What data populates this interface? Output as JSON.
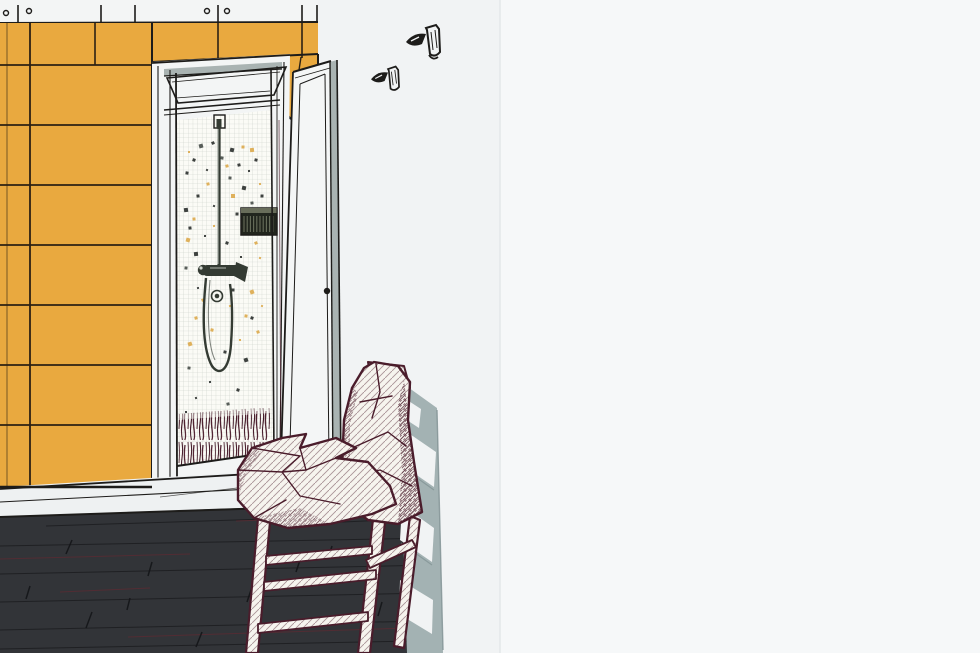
{
  "scene": {
    "description": "bathroom-corner-illustration",
    "canvas": {
      "width": 980,
      "height": 653,
      "illustration_width": 500
    },
    "colors": {
      "paper": "#f1f3f4",
      "paper_right": "#f6f8f9",
      "ink": "#1d1c1a",
      "grout": "#2c2113",
      "tile_yellow": "#e9a93f",
      "niche_white": "#f3f5f5",
      "door_white": "#f4f6f6",
      "door_edge_gray": "#a9b3b2",
      "mosaic_bg": "#fbfbf6",
      "mosaic_grid": "#c8cdc7",
      "speck_dark": "#2e3230",
      "speck_soft": "#4a504c",
      "speck_tan": "#dcaa4e",
      "metal_dark": "#343b33",
      "metal_light": "#cfd4cc",
      "radio_body": "#21251d",
      "radio_slat": "#707662",
      "maroon": "#4a1c2b",
      "maroon_deep": "#401624",
      "fabric_cream": "#f6f4ee",
      "shadow_gray": "#a3b2b3",
      "shadow_gray_dark": "#7f9092",
      "floor_dark": "#323438",
      "floor_seam": "#1d1e21",
      "floor_seam_red": "#5a2b33",
      "baseboard_white": "#eef1f2",
      "divider": "#e4e8e9"
    },
    "top_strip": {
      "end_x": 318,
      "height": 23,
      "ticks": [
        18,
        101,
        135,
        218,
        302,
        317
      ],
      "screws": [
        [
          6,
          13
        ],
        [
          29,
          11
        ],
        [
          207,
          11
        ],
        [
          227,
          11
        ]
      ]
    },
    "tile_wall": {
      "x": 0,
      "y": 23,
      "width": 152,
      "bottom": 487,
      "row_lines": [
        65,
        125,
        185,
        245,
        305,
        365,
        425
      ],
      "column_joint_x": 30,
      "row1_joint_x": 95,
      "left_inner_line_x": 7,
      "top_band": {
        "x1": 152,
        "x2": 318,
        "top": 23,
        "bl": 62,
        "br": 54,
        "joints": [
          218,
          302
        ]
      }
    },
    "mosaic_speckles": [
      [
        201,
        146,
        4,
        0
      ],
      [
        213,
        143,
        3,
        0
      ],
      [
        194,
        160,
        3,
        0
      ],
      [
        187,
        173,
        3,
        0
      ],
      [
        207,
        170,
        2,
        0
      ],
      [
        222,
        158,
        3,
        0
      ],
      [
        232,
        150,
        4,
        0
      ],
      [
        239,
        165,
        3,
        0
      ],
      [
        249,
        171,
        2,
        0
      ],
      [
        256,
        160,
        3,
        0
      ],
      [
        230,
        178,
        3,
        0
      ],
      [
        244,
        188,
        4,
        0
      ],
      [
        198,
        196,
        3,
        0
      ],
      [
        186,
        210,
        4,
        0
      ],
      [
        214,
        206,
        2,
        0
      ],
      [
        252,
        203,
        3,
        0
      ],
      [
        262,
        196,
        3,
        0
      ],
      [
        237,
        214,
        3,
        0
      ],
      [
        190,
        228,
        3,
        0
      ],
      [
        205,
        236,
        2,
        0
      ],
      [
        246,
        232,
        3,
        0
      ],
      [
        258,
        226,
        2,
        0
      ],
      [
        227,
        243,
        3,
        0
      ],
      [
        196,
        254,
        4,
        0
      ],
      [
        241,
        257,
        2,
        0
      ],
      [
        186,
        268,
        3,
        0
      ],
      [
        233,
        290,
        3,
        0
      ],
      [
        198,
        288,
        2,
        0
      ],
      [
        252,
        318,
        3,
        0
      ],
      [
        225,
        352,
        3,
        0
      ],
      [
        189,
        368,
        3,
        0
      ],
      [
        246,
        360,
        4,
        0
      ],
      [
        210,
        382,
        2,
        0
      ],
      [
        238,
        390,
        3,
        0
      ],
      [
        196,
        398,
        2,
        0
      ],
      [
        228,
        404,
        3,
        0
      ],
      [
        186,
        412,
        2,
        0
      ],
      [
        219,
        139,
        3,
        1
      ],
      [
        243,
        147,
        3,
        1
      ],
      [
        189,
        152,
        2,
        1
      ],
      [
        227,
        166,
        3,
        1
      ],
      [
        252,
        150,
        4,
        1
      ],
      [
        208,
        184,
        3,
        1
      ],
      [
        233,
        196,
        4,
        1
      ],
      [
        260,
        184,
        2,
        1
      ],
      [
        194,
        219,
        3,
        1
      ],
      [
        249,
        216,
        4,
        1
      ],
      [
        214,
        226,
        2,
        1
      ],
      [
        256,
        243,
        3,
        1
      ],
      [
        188,
        240,
        4,
        1
      ],
      [
        235,
        268,
        3,
        1
      ],
      [
        260,
        258,
        2,
        1
      ],
      [
        203,
        300,
        3,
        1
      ],
      [
        252,
        292,
        4,
        1
      ],
      [
        230,
        306,
        2,
        1
      ],
      [
        196,
        318,
        3,
        1
      ],
      [
        246,
        316,
        3,
        1
      ],
      [
        262,
        306,
        2,
        1
      ],
      [
        212,
        330,
        3,
        1
      ],
      [
        190,
        344,
        4,
        1
      ],
      [
        240,
        340,
        2,
        1
      ],
      [
        258,
        332,
        3,
        1
      ]
    ],
    "hooks": [
      {
        "x": 406,
        "y": 24,
        "scale": 1.0
      },
      {
        "x": 371,
        "y": 64,
        "scale": 0.85
      }
    ],
    "floor": {
      "dark_seams": [
        [
          0,
          546,
          436,
          538
        ],
        [
          0,
          574,
          434,
          565
        ],
        [
          0,
          602,
          430,
          593
        ],
        [
          0,
          630,
          426,
          621
        ],
        [
          46,
          526,
          300,
          518
        ],
        [
          0,
          649,
          416,
          641
        ],
        [
          320,
          523,
          432,
          518
        ]
      ],
      "red_seams": [
        [
          0,
          559,
          190,
          554
        ],
        [
          128,
          637,
          408,
          628
        ],
        [
          236,
          521,
          348,
          517
        ],
        [
          60,
          592,
          150,
          588
        ]
      ],
      "scratches": [
        [
          72,
          540,
          66,
          554
        ],
        [
          152,
          562,
          148,
          576
        ],
        [
          252,
          587,
          247,
          602
        ],
        [
          92,
          612,
          86,
          628
        ],
        [
          332,
          546,
          328,
          559
        ],
        [
          202,
          632,
          196,
          647
        ],
        [
          382,
          602,
          378,
          616
        ],
        [
          30,
          586,
          26,
          599
        ],
        [
          130,
          598,
          127,
          610
        ],
        [
          300,
          560,
          296,
          572
        ]
      ]
    }
  }
}
